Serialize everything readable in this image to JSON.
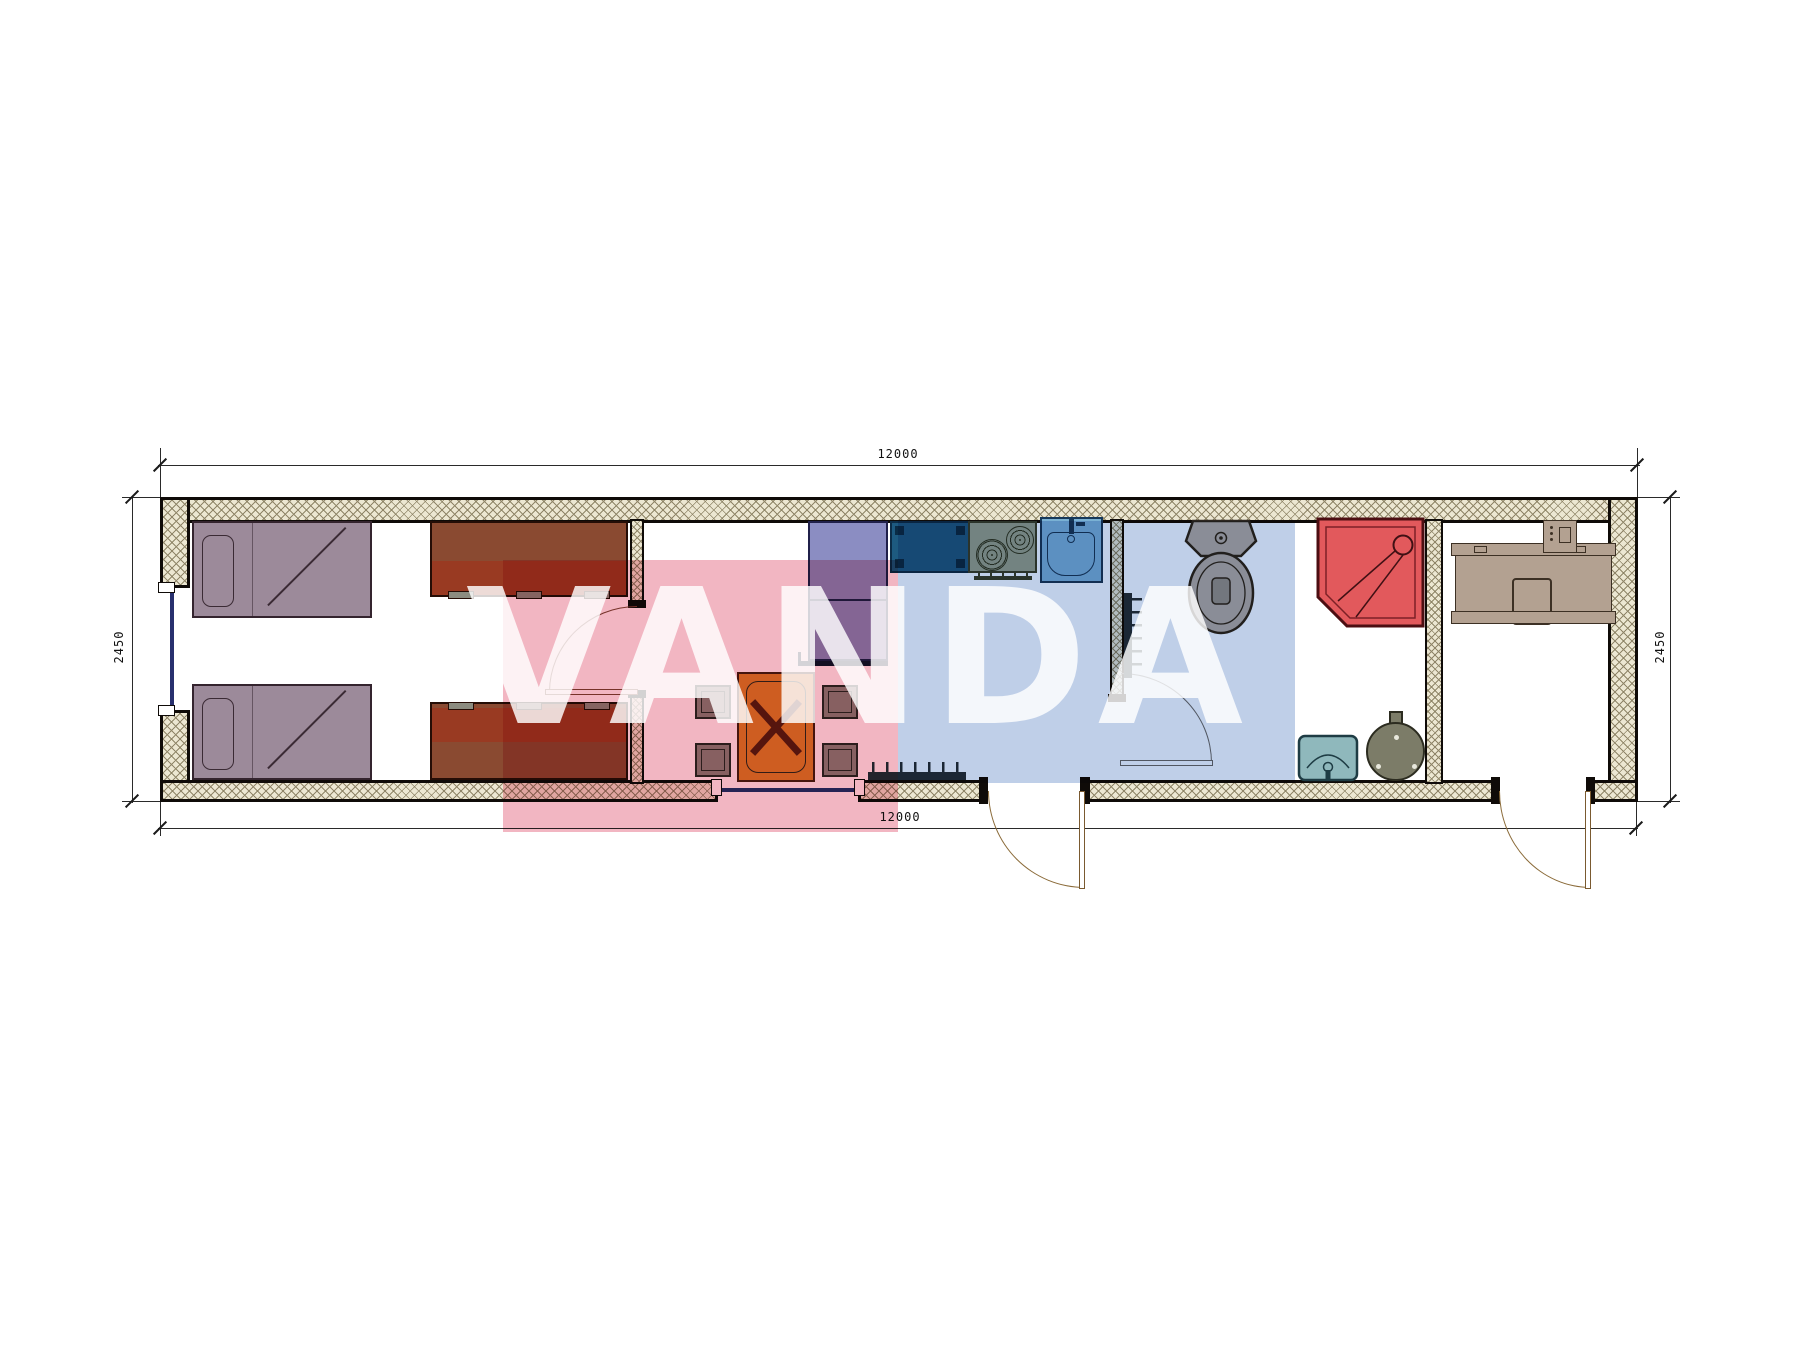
{
  "title": "container-house-floor-plan",
  "watermark": {
    "text": "VANDA",
    "red_block": "#f2b6c2",
    "blue_block": "#bfcfe8",
    "letter_color": "#ffffff"
  },
  "dims": {
    "top": "12000",
    "bottom": "12000",
    "left": "2450",
    "right": "2450",
    "units": "mm"
  },
  "structure": {
    "exterior_walls": [
      "top",
      "bottom-with-window-and-two-doors",
      "left-with-window",
      "right"
    ],
    "windows": [
      "left-wall-window",
      "bottom-wall-living-window"
    ],
    "doors": [
      "bedroom-door",
      "bathroom-door",
      "entry-door-main",
      "entry-door-study"
    ],
    "wall_fill": "#ece7d2",
    "wall_line": "#0f0b08"
  },
  "rooms": [
    {
      "name": "bedroom",
      "furniture": [
        "single-bed",
        "single-bed",
        "dresser",
        "dresser"
      ]
    },
    {
      "name": "living-dining",
      "furniture": [
        "dining-table",
        "stool",
        "stool",
        "stool",
        "stool",
        "fridge",
        "radiator"
      ]
    },
    {
      "name": "kitchen",
      "furniture": [
        "counter-cabinet",
        "cooktop-two-burners",
        "kitchen-sink"
      ]
    },
    {
      "name": "bathroom",
      "furniture": [
        "toilet",
        "corner-shower",
        "wash-basin",
        "water-heater",
        "radiator"
      ]
    },
    {
      "name": "study",
      "furniture": [
        "desk",
        "chair",
        "computer"
      ]
    }
  ],
  "colors": {
    "bed": "#9c8a9a",
    "cabinet": "#8a4a31",
    "fridge": "#8b8dc2",
    "counter": "#1d5a80",
    "stove": "#99a28e",
    "sink": "#7ab1d4",
    "toilet": "#b8aea6",
    "shower": "#e2595c",
    "basin": "#8fb8bc",
    "boiler": "#7c7c68",
    "desk": "#b3a191",
    "table": "#d9822b",
    "stool": "#8e8780"
  }
}
